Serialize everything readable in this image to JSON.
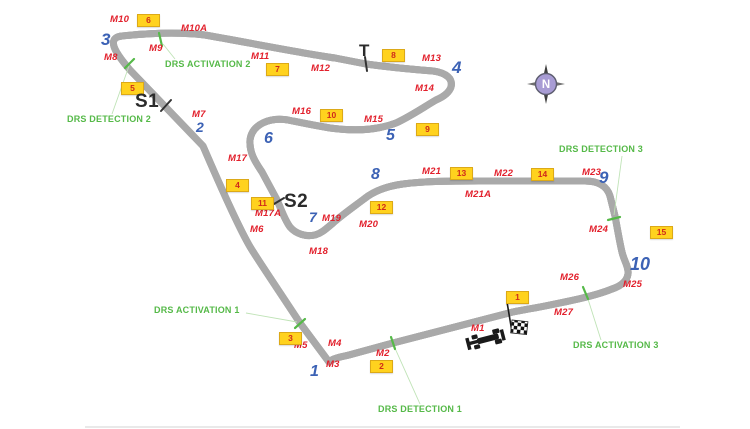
{
  "title": "Circuit track map",
  "compass": {
    "label": "N"
  },
  "colors": {
    "marshal": "#e2202c",
    "turn": "#3c62b5",
    "drs": "#55b948",
    "sector": "#2b2b2b",
    "panel_fill": "#ffd21e",
    "panel_border": "#dca918",
    "panel_text": "#cf2a1b",
    "track_edge": "#a9a9a9",
    "track_fill": "#e6e6e6"
  },
  "map": {
    "turns": [
      {
        "label": "1",
        "x": 310,
        "y": 364,
        "fs": 16
      },
      {
        "label": "2",
        "x": 196,
        "y": 120,
        "fs": 14
      },
      {
        "label": "3",
        "x": 101,
        "y": 31,
        "fs": 17
      },
      {
        "label": "4",
        "x": 452,
        "y": 59,
        "fs": 17
      },
      {
        "label": "5",
        "x": 386,
        "y": 128,
        "fs": 16
      },
      {
        "label": "6",
        "x": 264,
        "y": 131,
        "fs": 16
      },
      {
        "label": "7",
        "x": 309,
        "y": 210,
        "fs": 14
      },
      {
        "label": "8",
        "x": 371,
        "y": 167,
        "fs": 16
      },
      {
        "label": "9",
        "x": 599,
        "y": 169,
        "fs": 17
      },
      {
        "label": "10",
        "x": 630,
        "y": 255,
        "fs": 18
      }
    ],
    "marshal_posts": [
      {
        "label": "M1",
        "x": 471,
        "y": 324
      },
      {
        "label": "M2",
        "x": 376,
        "y": 349
      },
      {
        "label": "M3",
        "x": 326,
        "y": 360
      },
      {
        "label": "M4",
        "x": 328,
        "y": 339
      },
      {
        "label": "M5",
        "x": 294,
        "y": 341
      },
      {
        "label": "M6",
        "x": 250,
        "y": 225
      },
      {
        "label": "M7",
        "x": 192,
        "y": 110
      },
      {
        "label": "M8",
        "x": 104,
        "y": 53
      },
      {
        "label": "M9",
        "x": 149,
        "y": 44
      },
      {
        "label": "M10",
        "x": 110,
        "y": 15
      },
      {
        "label": "M10A",
        "x": 181,
        "y": 24
      },
      {
        "label": "M11",
        "x": 251,
        "y": 52
      },
      {
        "label": "M12",
        "x": 311,
        "y": 64
      },
      {
        "label": "M13",
        "x": 422,
        "y": 54
      },
      {
        "label": "M14",
        "x": 415,
        "y": 84
      },
      {
        "label": "M15",
        "x": 364,
        "y": 115
      },
      {
        "label": "M16",
        "x": 292,
        "y": 107
      },
      {
        "label": "M17",
        "x": 228,
        "y": 154
      },
      {
        "label": "M17A",
        "x": 255,
        "y": 209
      },
      {
        "label": "M18",
        "x": 309,
        "y": 247
      },
      {
        "label": "M19",
        "x": 322,
        "y": 214
      },
      {
        "label": "M20",
        "x": 359,
        "y": 220
      },
      {
        "label": "M21",
        "x": 422,
        "y": 167
      },
      {
        "label": "M21A",
        "x": 465,
        "y": 190
      },
      {
        "label": "M22",
        "x": 494,
        "y": 169
      },
      {
        "label": "M23",
        "x": 582,
        "y": 168
      },
      {
        "label": "M24",
        "x": 589,
        "y": 225
      },
      {
        "label": "M25",
        "x": 623,
        "y": 280
      },
      {
        "label": "M26",
        "x": 560,
        "y": 273
      },
      {
        "label": "M27",
        "x": 554,
        "y": 308
      }
    ],
    "light_panels": [
      {
        "label": "1",
        "x": 506,
        "y": 291
      },
      {
        "label": "2",
        "x": 370,
        "y": 360
      },
      {
        "label": "3",
        "x": 279,
        "y": 332
      },
      {
        "label": "4",
        "x": 226,
        "y": 179
      },
      {
        "label": "5",
        "x": 121,
        "y": 82
      },
      {
        "label": "6",
        "x": 137,
        "y": 14
      },
      {
        "label": "7",
        "x": 266,
        "y": 63
      },
      {
        "label": "8",
        "x": 382,
        "y": 49
      },
      {
        "label": "9",
        "x": 416,
        "y": 123
      },
      {
        "label": "10",
        "x": 320,
        "y": 109
      },
      {
        "label": "11",
        "x": 251,
        "y": 197
      },
      {
        "label": "12",
        "x": 370,
        "y": 201
      },
      {
        "label": "13",
        "x": 450,
        "y": 167
      },
      {
        "label": "14",
        "x": 531,
        "y": 168
      },
      {
        "label": "15",
        "x": 650,
        "y": 226
      }
    ],
    "sector_markers": [
      {
        "label": "S1",
        "x": 135,
        "y": 92,
        "fs": 19
      },
      {
        "label": "S2",
        "x": 284,
        "y": 192,
        "fs": 19
      },
      {
        "label": "T",
        "x": 359,
        "y": 42,
        "fs": 17
      }
    ],
    "drs_zones": [
      {
        "label": "DRS ACTIVATION 2",
        "x": 165,
        "y": 60
      },
      {
        "label": "DRS DETECTION 2",
        "x": 67,
        "y": 115
      },
      {
        "label": "DRS ACTIVATION 1",
        "x": 154,
        "y": 306
      },
      {
        "label": "DRS DETECTION 1",
        "x": 378,
        "y": 405
      },
      {
        "label": "DRS DETECTION 3",
        "x": 559,
        "y": 145
      },
      {
        "label": "DRS ACTIVATION 3",
        "x": 573,
        "y": 341
      }
    ]
  }
}
